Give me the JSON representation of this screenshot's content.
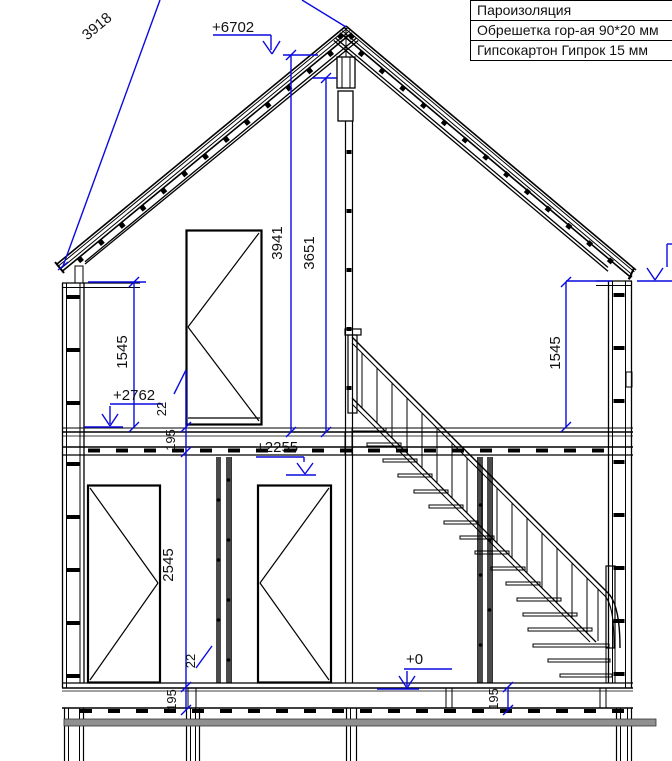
{
  "colors": {
    "dimension_blue": "#0a0ae0",
    "line_black": "#000000",
    "beam_gray": "#909090"
  },
  "drawing": {
    "legend": {
      "rows": [
        "Пароизоляция",
        "Обрешетка гор-ая 90*20 мм",
        "Гипсокартон Гипрок 15 мм"
      ]
    },
    "dims": {
      "roof_slope_len": "3918",
      "ridge_level": "+6702",
      "ridge_to_floor2": "3941",
      "ceiling_to_floor2": "3651",
      "knee_wall_left": "1545",
      "knee_wall_right": "1545",
      "floor2_level": "+2762",
      "floor2_sheathing": "22",
      "floor2_joist": "195",
      "floor1_wall_height": "2545",
      "floor1_sheathing": "22",
      "door_head_level": "+2255",
      "ground_level": "+0",
      "floor1_joist_left": "195",
      "floor1_joist_right": "195"
    }
  }
}
